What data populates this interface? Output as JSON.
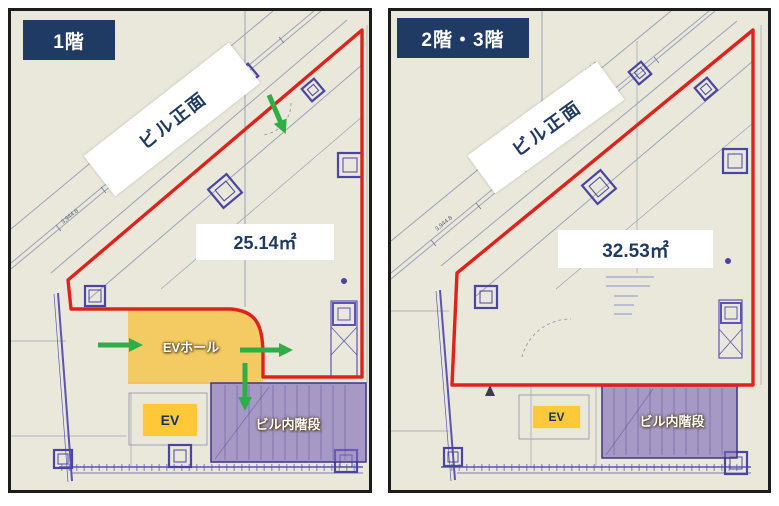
{
  "title": "Building floor plans",
  "colors": {
    "badge_navy": "#1f3a63",
    "text_navy": "#1f3a63",
    "outline_red": "#df221c",
    "ev_hall_yellow": "#f6c244",
    "ev_box_yellow": "#ffc838",
    "stairs_purple": "#7c69ba",
    "arrow_green": "#2fae47",
    "plan_paper": "#eae8da"
  },
  "panels": [
    {
      "floor_label": "1階",
      "front_label": "ビル正面",
      "area_label": "25.14㎡",
      "ev_hall_label": "EVホール",
      "ev_label": "EV",
      "stairs_label": "ビル内階段"
    },
    {
      "floor_label": "2階・3階",
      "front_label": "ビル正面",
      "area_label": "32.53㎡",
      "ev_label": "EV",
      "stairs_label": "ビル内階段"
    }
  ],
  "drawing": {
    "dim_labels": [
      "4,611.2",
      "6,598.1",
      "3,944.8"
    ]
  }
}
